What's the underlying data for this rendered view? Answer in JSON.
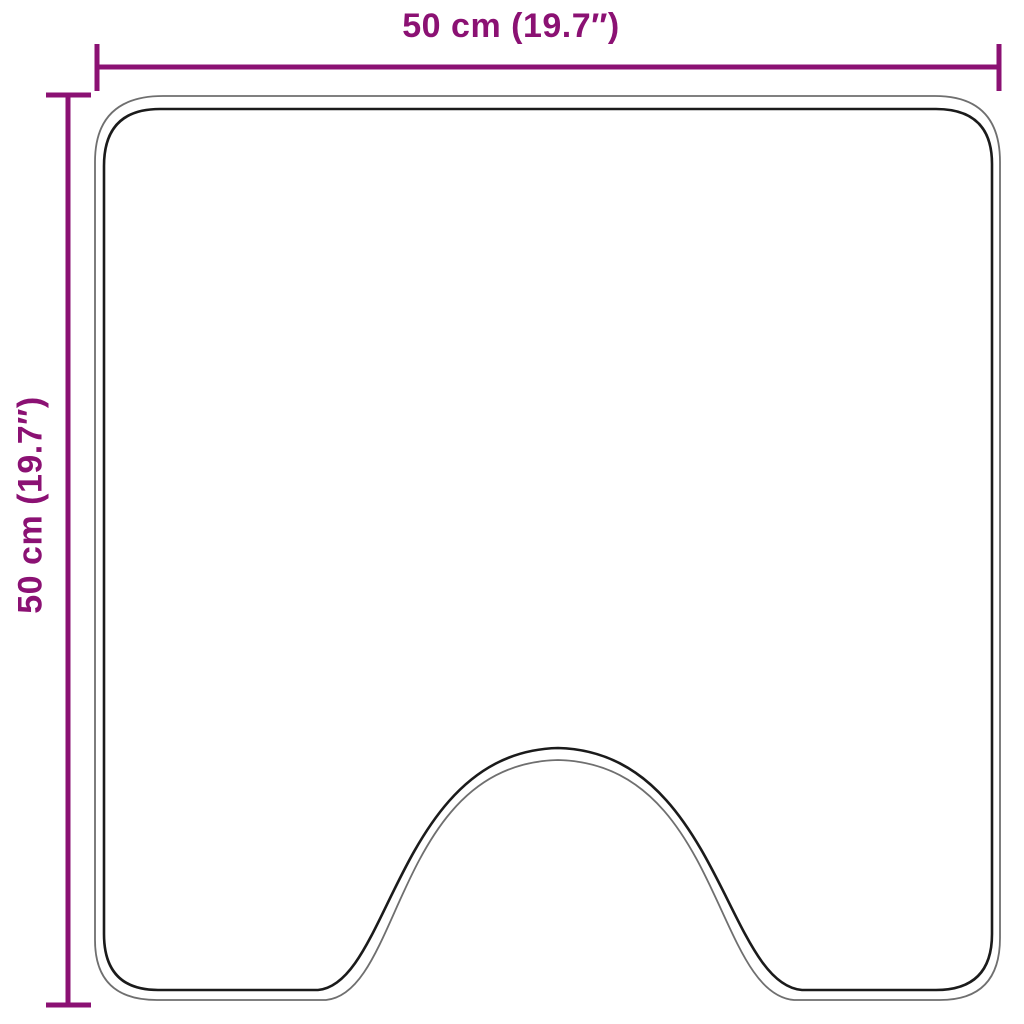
{
  "diagram": {
    "width_label": "50 cm (19.7″)",
    "height_label": "50 cm (19.7″)",
    "colors": {
      "dimension": "#8B1173",
      "outline_inner": "#1b1b1b",
      "outline_outer": "#6f6f6f",
      "background": "#ffffff"
    }
  }
}
